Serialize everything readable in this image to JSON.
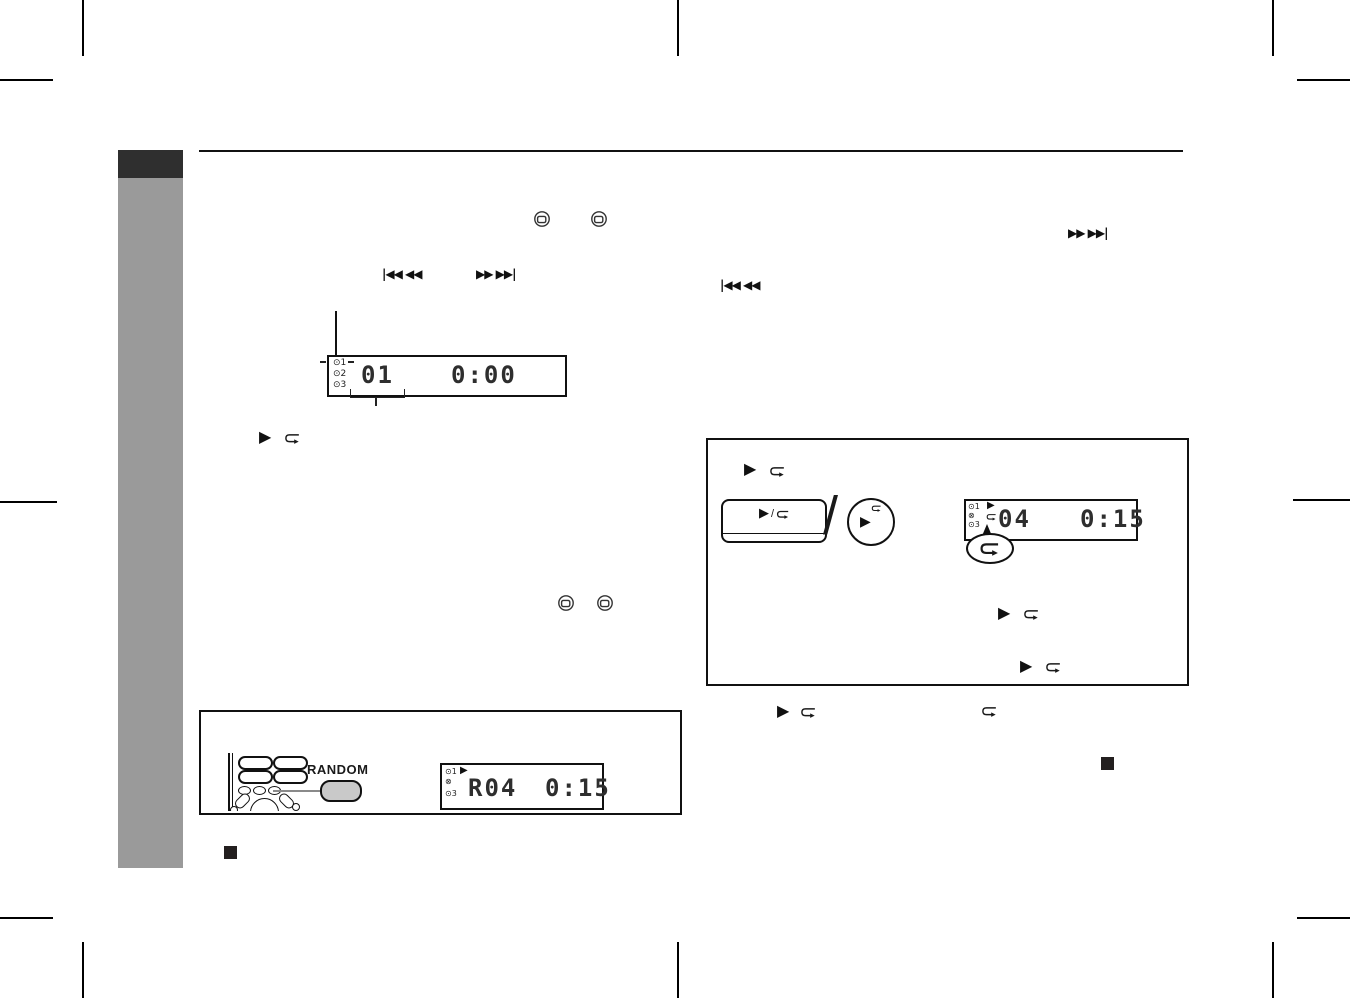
{
  "colors": {
    "sidebar_gray": "#9a9a9a",
    "sidebar_dark": "#2f2f2f",
    "random_button_fill": "#c9c9c9",
    "ink": "#1a1a1a"
  },
  "glyphs": {
    "play": "▶",
    "slash": "/",
    "skip_back": "|◀◀ ◀◀",
    "skip_fwd": "▶▶ ▶▶|"
  },
  "displays": {
    "d1": {
      "ind1": "⊙1",
      "ind2": "⊙2",
      "ind3": "⊙3",
      "track": "01",
      "time": "0:00"
    },
    "d2": {
      "play": "▶",
      "ind1": "⊙1",
      "ind2": "⊗",
      "ind3": "⊙3",
      "track": "04",
      "time": "0:15"
    },
    "d3": {
      "play": "▶",
      "ind1": "⊙1",
      "ind2": "⊗",
      "ind3": "⊙3",
      "track": "R04",
      "time": "0:15"
    }
  },
  "random": {
    "label": "RANDOM"
  }
}
